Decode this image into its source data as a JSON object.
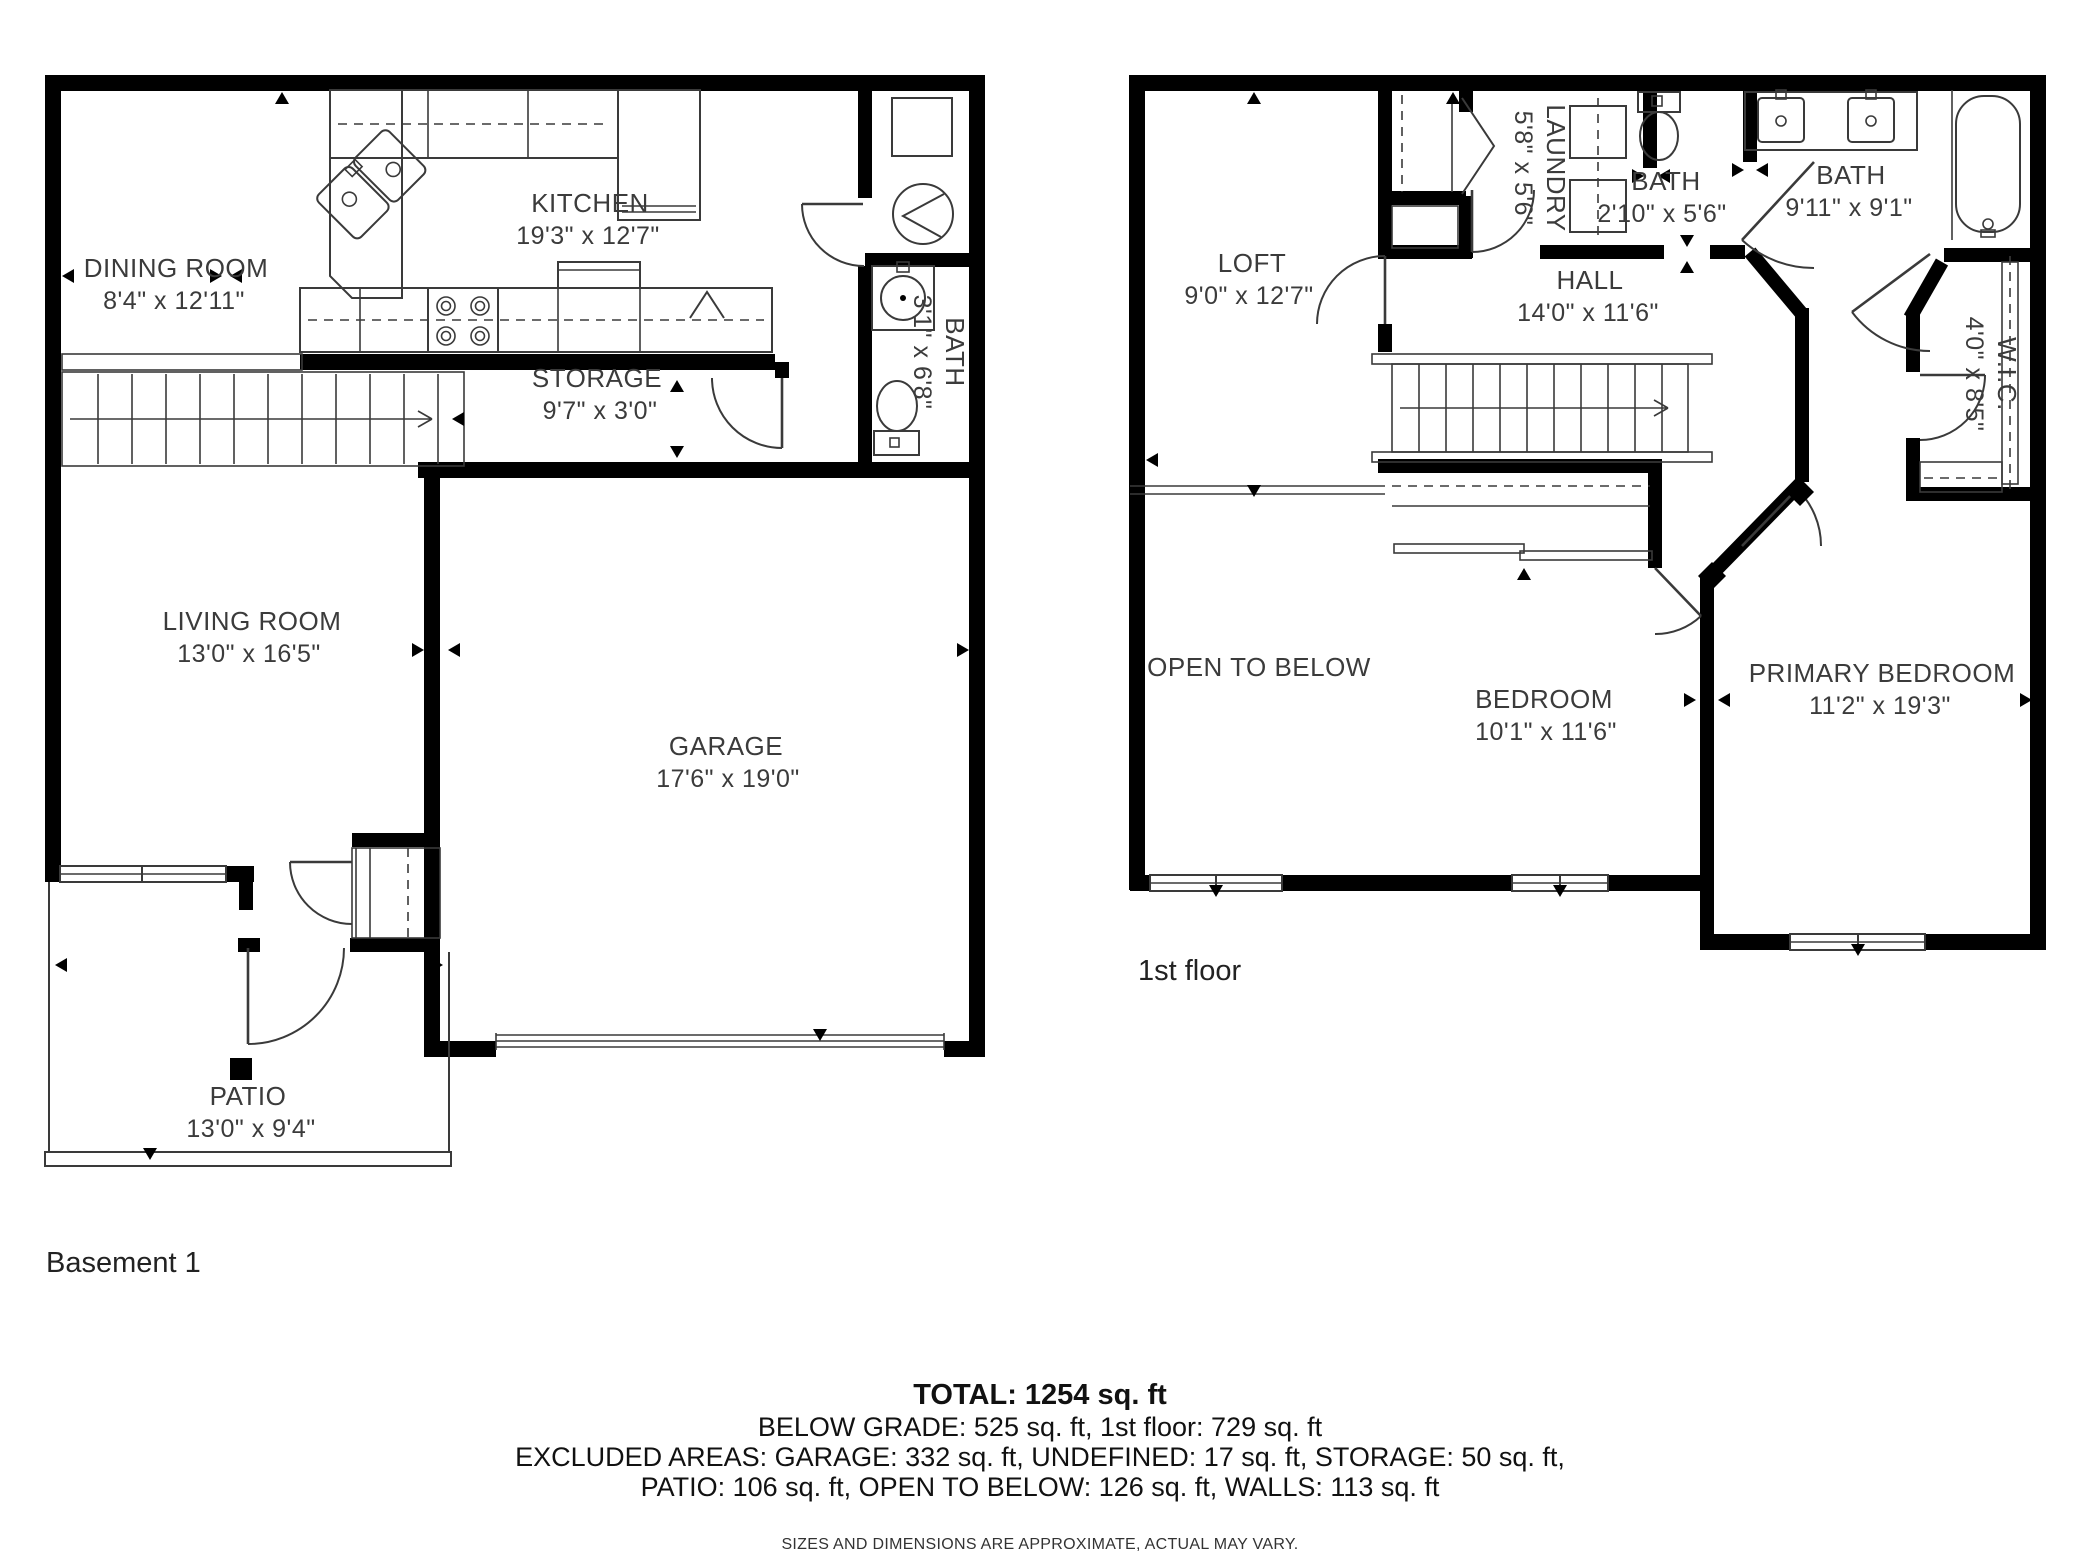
{
  "basement": {
    "floor_label": "Basement 1",
    "rooms": {
      "dining": {
        "name": "DINING ROOM",
        "dims": "8'4\" x 12'11\""
      },
      "kitchen": {
        "name": "KITCHEN",
        "dims": "19'3\" x 12'7\""
      },
      "storage": {
        "name": "STORAGE",
        "dims": "9'7\" x 3'0\""
      },
      "bath": {
        "name": "BATH",
        "dims": "3'1\" x 6'8\""
      },
      "living": {
        "name": "LIVING ROOM",
        "dims": "13'0\" x 16'5\""
      },
      "garage": {
        "name": "GARAGE",
        "dims": "17'6\" x 19'0\""
      },
      "patio": {
        "name": "PATIO",
        "dims": "13'0\" x 9'4\""
      }
    }
  },
  "first_floor": {
    "floor_label": "1st floor",
    "rooms": {
      "loft": {
        "name": "LOFT",
        "dims": "9'0\" x 12'7\""
      },
      "laundry": {
        "name": "LAUNDRY",
        "dims": "5'8\" x 5'6\""
      },
      "bath_small": {
        "name": "BATH",
        "dims": "2'10\" x 5'6\""
      },
      "bath_large": {
        "name": "BATH",
        "dims": "9'11\" x 9'1\""
      },
      "hall": {
        "name": "HALL",
        "dims": "14'0\" x 11'6\""
      },
      "wic": {
        "name": "W.I.C.",
        "dims": "4'0\" x 8'5\""
      },
      "open_below": {
        "name": "OPEN TO BELOW"
      },
      "bedroom": {
        "name": "BEDROOM",
        "dims": "10'1\" x 11'6\""
      },
      "primary": {
        "name": "PRIMARY BEDROOM",
        "dims": "11'2\" x 19'3\""
      }
    }
  },
  "summary": {
    "total": "TOTAL: 1254 sq. ft",
    "line1": "BELOW GRADE: 525 sq. ft, 1st floor: 729 sq. ft",
    "line2": "EXCLUDED AREAS: GARAGE: 332 sq. ft, UNDEFINED: 17 sq. ft, STORAGE: 50 sq. ft,",
    "line3": "PATIO: 106 sq. ft, OPEN TO BELOW: 126 sq. ft, WALLS: 113 sq. ft",
    "disclaimer": "SIZES AND DIMENSIONS ARE APPROXIMATE, ACTUAL MAY VARY."
  },
  "colors": {
    "wall": "#000000",
    "line": "#3a3a3a",
    "text": "#3b3b3b",
    "background": "#ffffff"
  }
}
